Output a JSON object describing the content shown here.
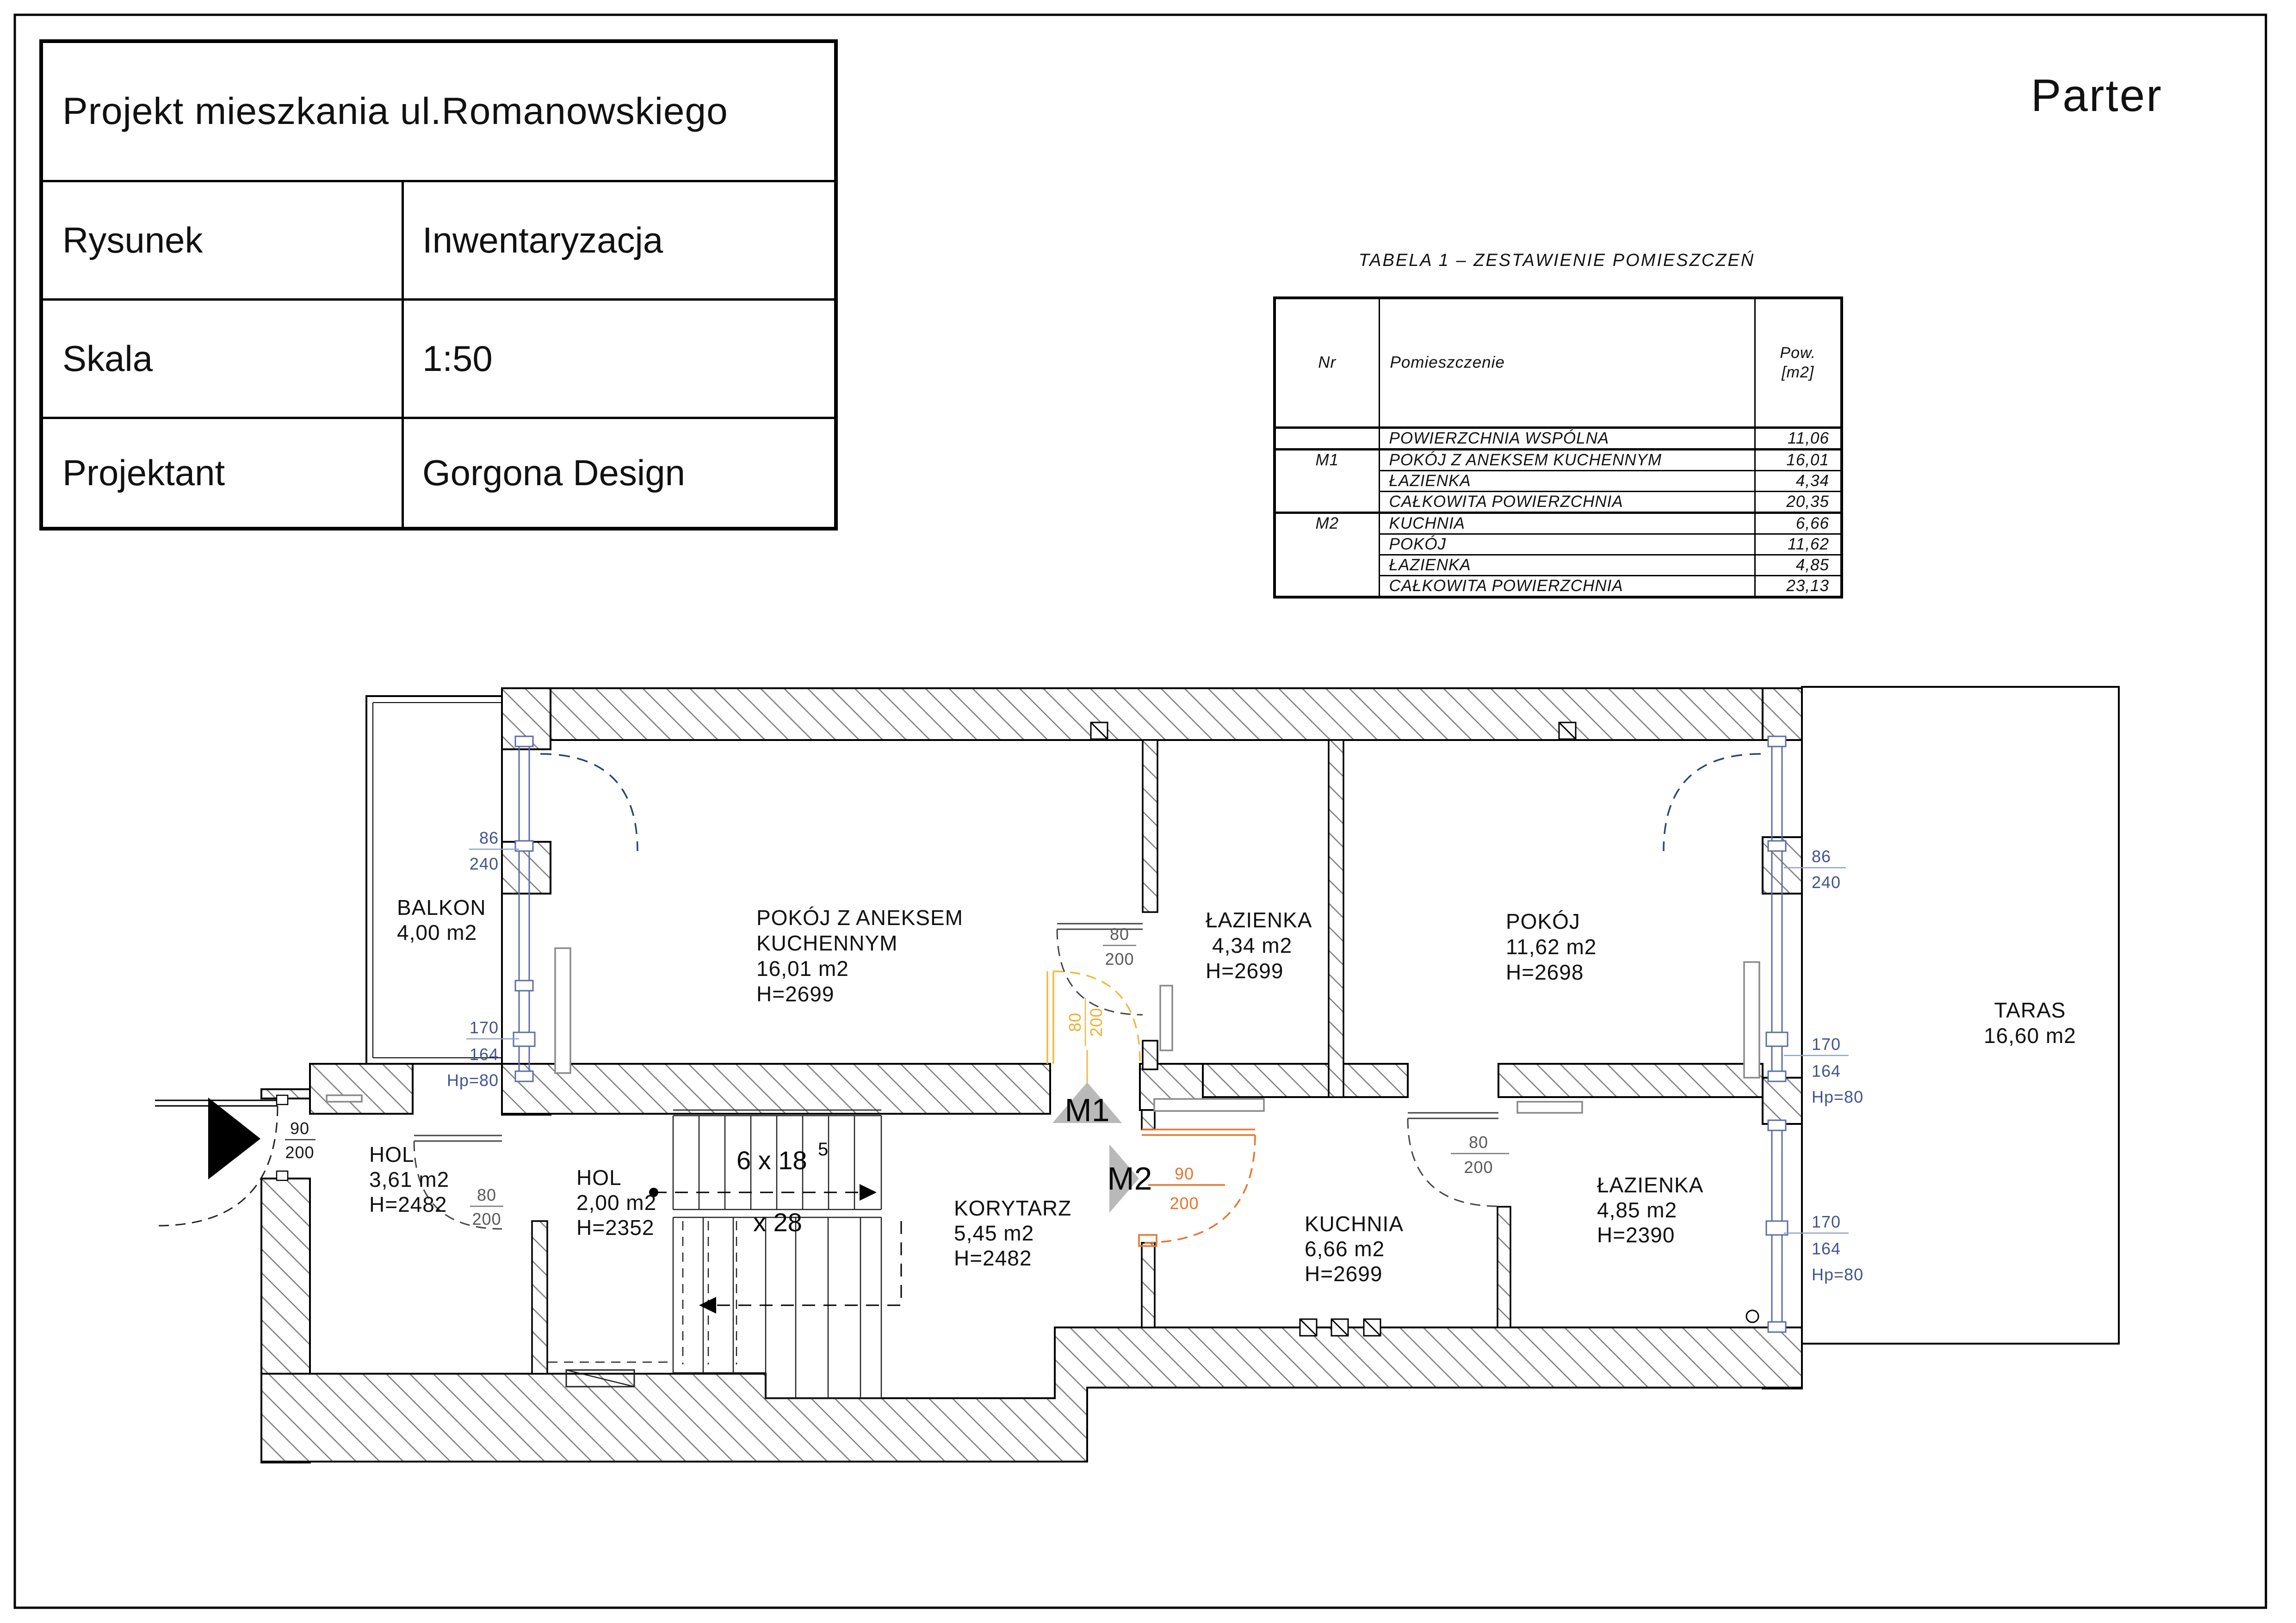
{
  "page": {
    "floor_label": "Parter"
  },
  "title_block": {
    "project_title": "Projekt mieszkania ul.Romanowskiego",
    "rows": [
      {
        "label": "Rysunek",
        "value": "Inwentaryzacja"
      },
      {
        "label": "Skala",
        "value": "1:50"
      },
      {
        "label": "Projektant",
        "value": "Gorgona Design"
      }
    ]
  },
  "summary_table": {
    "title": "TABELA 1 – ZESTAWIENIE POMIESZCZEŃ",
    "headers": {
      "nr": "Nr",
      "room": "Pomieszczenie",
      "area_line1": "Pow.",
      "area_line2": "[m2]"
    },
    "rows": [
      {
        "nr": "",
        "room": "POWIERZCHNIA WSPÓLNA",
        "area": "11,06"
      },
      {
        "nr": "M1",
        "room": "POKÓJ Z ANEKSEM KUCHENNYM",
        "area": "16,01"
      },
      {
        "nr": "",
        "room": "ŁAZIENKA",
        "area": "4,34"
      },
      {
        "nr": "",
        "room": "CAŁKOWITA POWIERZCHNIA",
        "area": "20,35"
      },
      {
        "nr": "M2",
        "room": "KUCHNIA",
        "area": "6,66"
      },
      {
        "nr": "",
        "room": "POKÓJ",
        "area": "11,62"
      },
      {
        "nr": "",
        "room": "ŁAZIENKA",
        "area": "4,85"
      },
      {
        "nr": "",
        "room": "CAŁKOWITA POWIERZCHNIA",
        "area": "23,13"
      }
    ]
  },
  "plan": {
    "rooms": {
      "balkon": {
        "name": "BALKON",
        "area": "4,00 m2"
      },
      "pokoj_aneks": {
        "name": "POKÓJ Z ANEKSEM",
        "name2": "KUCHENNYM",
        "area": "16,01 m2",
        "height": "H=2699"
      },
      "lazienka_m1": {
        "name": "ŁAZIENKA",
        "area": "4,34 m2",
        "height": "H=2699"
      },
      "pokoj": {
        "name": "POKÓJ",
        "area": "11,62 m2",
        "height": "H=2698"
      },
      "taras": {
        "name": "TARAS",
        "area": "16,60 m2"
      },
      "hol_wejscie": {
        "name": "HOL",
        "area": "3,61 m2",
        "height": "H=2482"
      },
      "hol_maly": {
        "name": "HOL",
        "area": "2,00 m2",
        "height": "H=2352"
      },
      "korytarz": {
        "name": "KORYTARZ",
        "area": "5,45 m2",
        "height": "H=2482"
      },
      "kuchnia": {
        "name": "KUCHNIA",
        "area": "6,66 m2",
        "height": "H=2699"
      },
      "lazienka_m2": {
        "name": "ŁAZIENKA",
        "area": "4,85 m2",
        "height": "H=2390"
      }
    },
    "markers": {
      "m1": "M1",
      "m2": "M2"
    },
    "stairs": {
      "riser_count": "6 x 18",
      "riser_sup": "5",
      "tread": "x 28"
    },
    "doors": {
      "entrance": {
        "w": "90",
        "h": "200"
      },
      "hol": {
        "w": "80",
        "h": "200"
      },
      "m1_pokoj_lazienka": {
        "w": "80",
        "h": "200"
      },
      "m1_entry": {
        "w": "80",
        "h": "200"
      },
      "m2_entry": {
        "w": "90",
        "h": "200"
      },
      "m2_kuchnia_lazienka": {
        "w": "80",
        "h": "200"
      }
    },
    "windows": {
      "left_balkon_door": {
        "w": "86",
        "h": "240"
      },
      "left_okno": {
        "w": "170",
        "h": "164",
        "hp": "Hp=80"
      },
      "right_taras_door": {
        "w": "86",
        "h": "240"
      },
      "right_okno": {
        "w": "170",
        "h": "164",
        "hp": "Hp=80"
      },
      "right_lazienka_okno": {
        "w": "170",
        "h": "164",
        "hp": "Hp=80"
      }
    },
    "colors": {
      "window_blue": "#41548e",
      "door_yellow": "#f2b93c",
      "door_orange": "#e8742c",
      "marker_gray": "#b9b9b9"
    }
  }
}
